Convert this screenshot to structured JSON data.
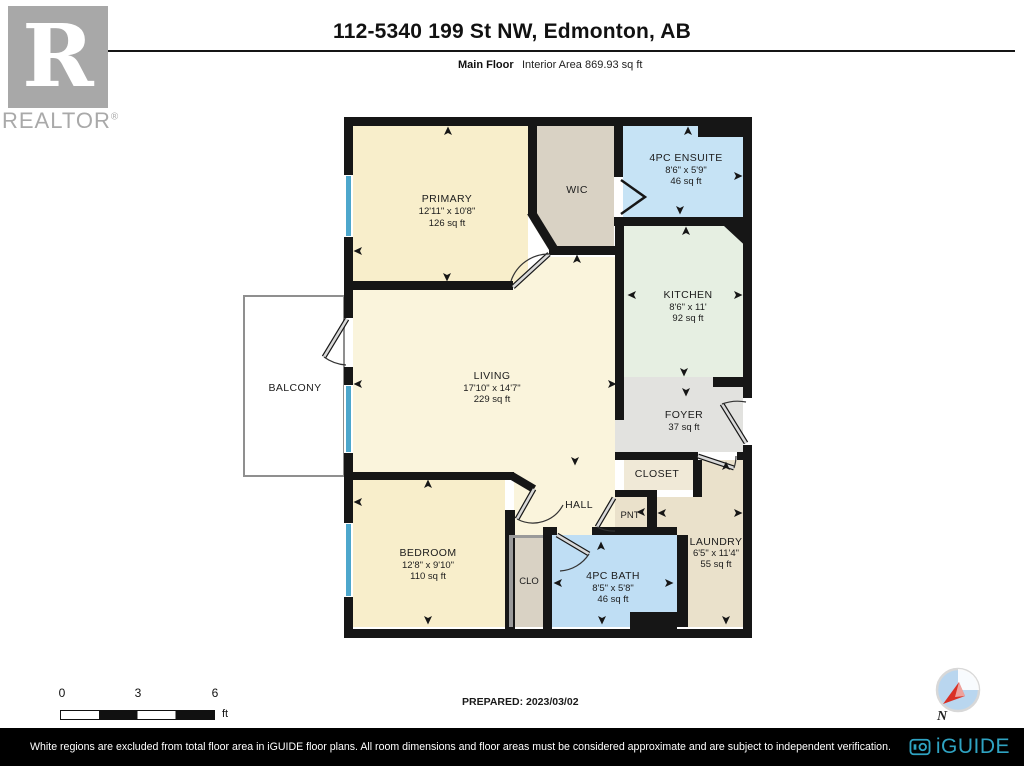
{
  "header": {
    "title": "112-5340 199 St NW, Edmonton, AB",
    "floor_label": "Main Floor",
    "area_label": "Interior Area 869.93 sq ft"
  },
  "branding": {
    "realtor_letter": "R",
    "realtor_text": "REALTOR",
    "registered_mark": "®",
    "iguide_text": "iGUIDE"
  },
  "rooms": {
    "primary": {
      "name": "PRIMARY",
      "dims": "12'11\" x 10'8\"",
      "area": "126 sq ft"
    },
    "wic": {
      "name": "WIC"
    },
    "ensuite": {
      "name": "4PC ENSUITE",
      "dims": "8'6\" x 5'9\"",
      "area": "46 sq ft"
    },
    "kitchen": {
      "name": "KITCHEN",
      "dims": "8'6\" x 11'",
      "area": "92 sq ft"
    },
    "living": {
      "name": "LIVING",
      "dims": "17'10\" x 14'7\"",
      "area": "229 sq ft"
    },
    "balcony": {
      "name": "BALCONY"
    },
    "foyer": {
      "name": "FOYER",
      "area": "37 sq ft"
    },
    "closet": {
      "name": "CLOSET"
    },
    "hall": {
      "name": "HALL"
    },
    "pnt": {
      "name": "PNT"
    },
    "laundry": {
      "name": "LAUNDRY",
      "dims": "6'5\" x 11'4\"",
      "area": "55 sq ft"
    },
    "bedroom": {
      "name": "BEDROOM",
      "dims": "12'8\" x 9'10\"",
      "area": "110 sq ft"
    },
    "clo": {
      "name": "CLO"
    },
    "bath": {
      "name": "4PC BATH",
      "dims": "8'5\" x 5'8\"",
      "area": "46 sq ft"
    }
  },
  "scale_bar": {
    "tick_0": "0",
    "tick_3": "3",
    "tick_6": "6",
    "unit": "ft"
  },
  "prepared_label": "PREPARED: 2023/03/02",
  "compass": {
    "north_label": "N"
  },
  "footer": {
    "disclaimer": "White regions are excluded from total floor area in iGUIDE floor plans. All room dimensions and floor areas must be considered approximate and are subject to independent verification."
  },
  "colors": {
    "wall": "#161616",
    "window_blue": "#4da7cc",
    "room_cream": "#f8eecb",
    "room_cream_light": "#faf4dc",
    "room_grey_beige": "#d9d2c4",
    "room_blue_ensuite": "#c6e3f5",
    "room_blue_bath": "#bfdef4",
    "room_mint": "#e6efe2",
    "room_grey": "#e2e2df",
    "room_beige": "#f0e9d7",
    "room_tan": "#eae1cb",
    "iguide_teal": "#2fa3c2",
    "compass_red": "#d93025",
    "logo_grey": "#a8a8a8"
  }
}
